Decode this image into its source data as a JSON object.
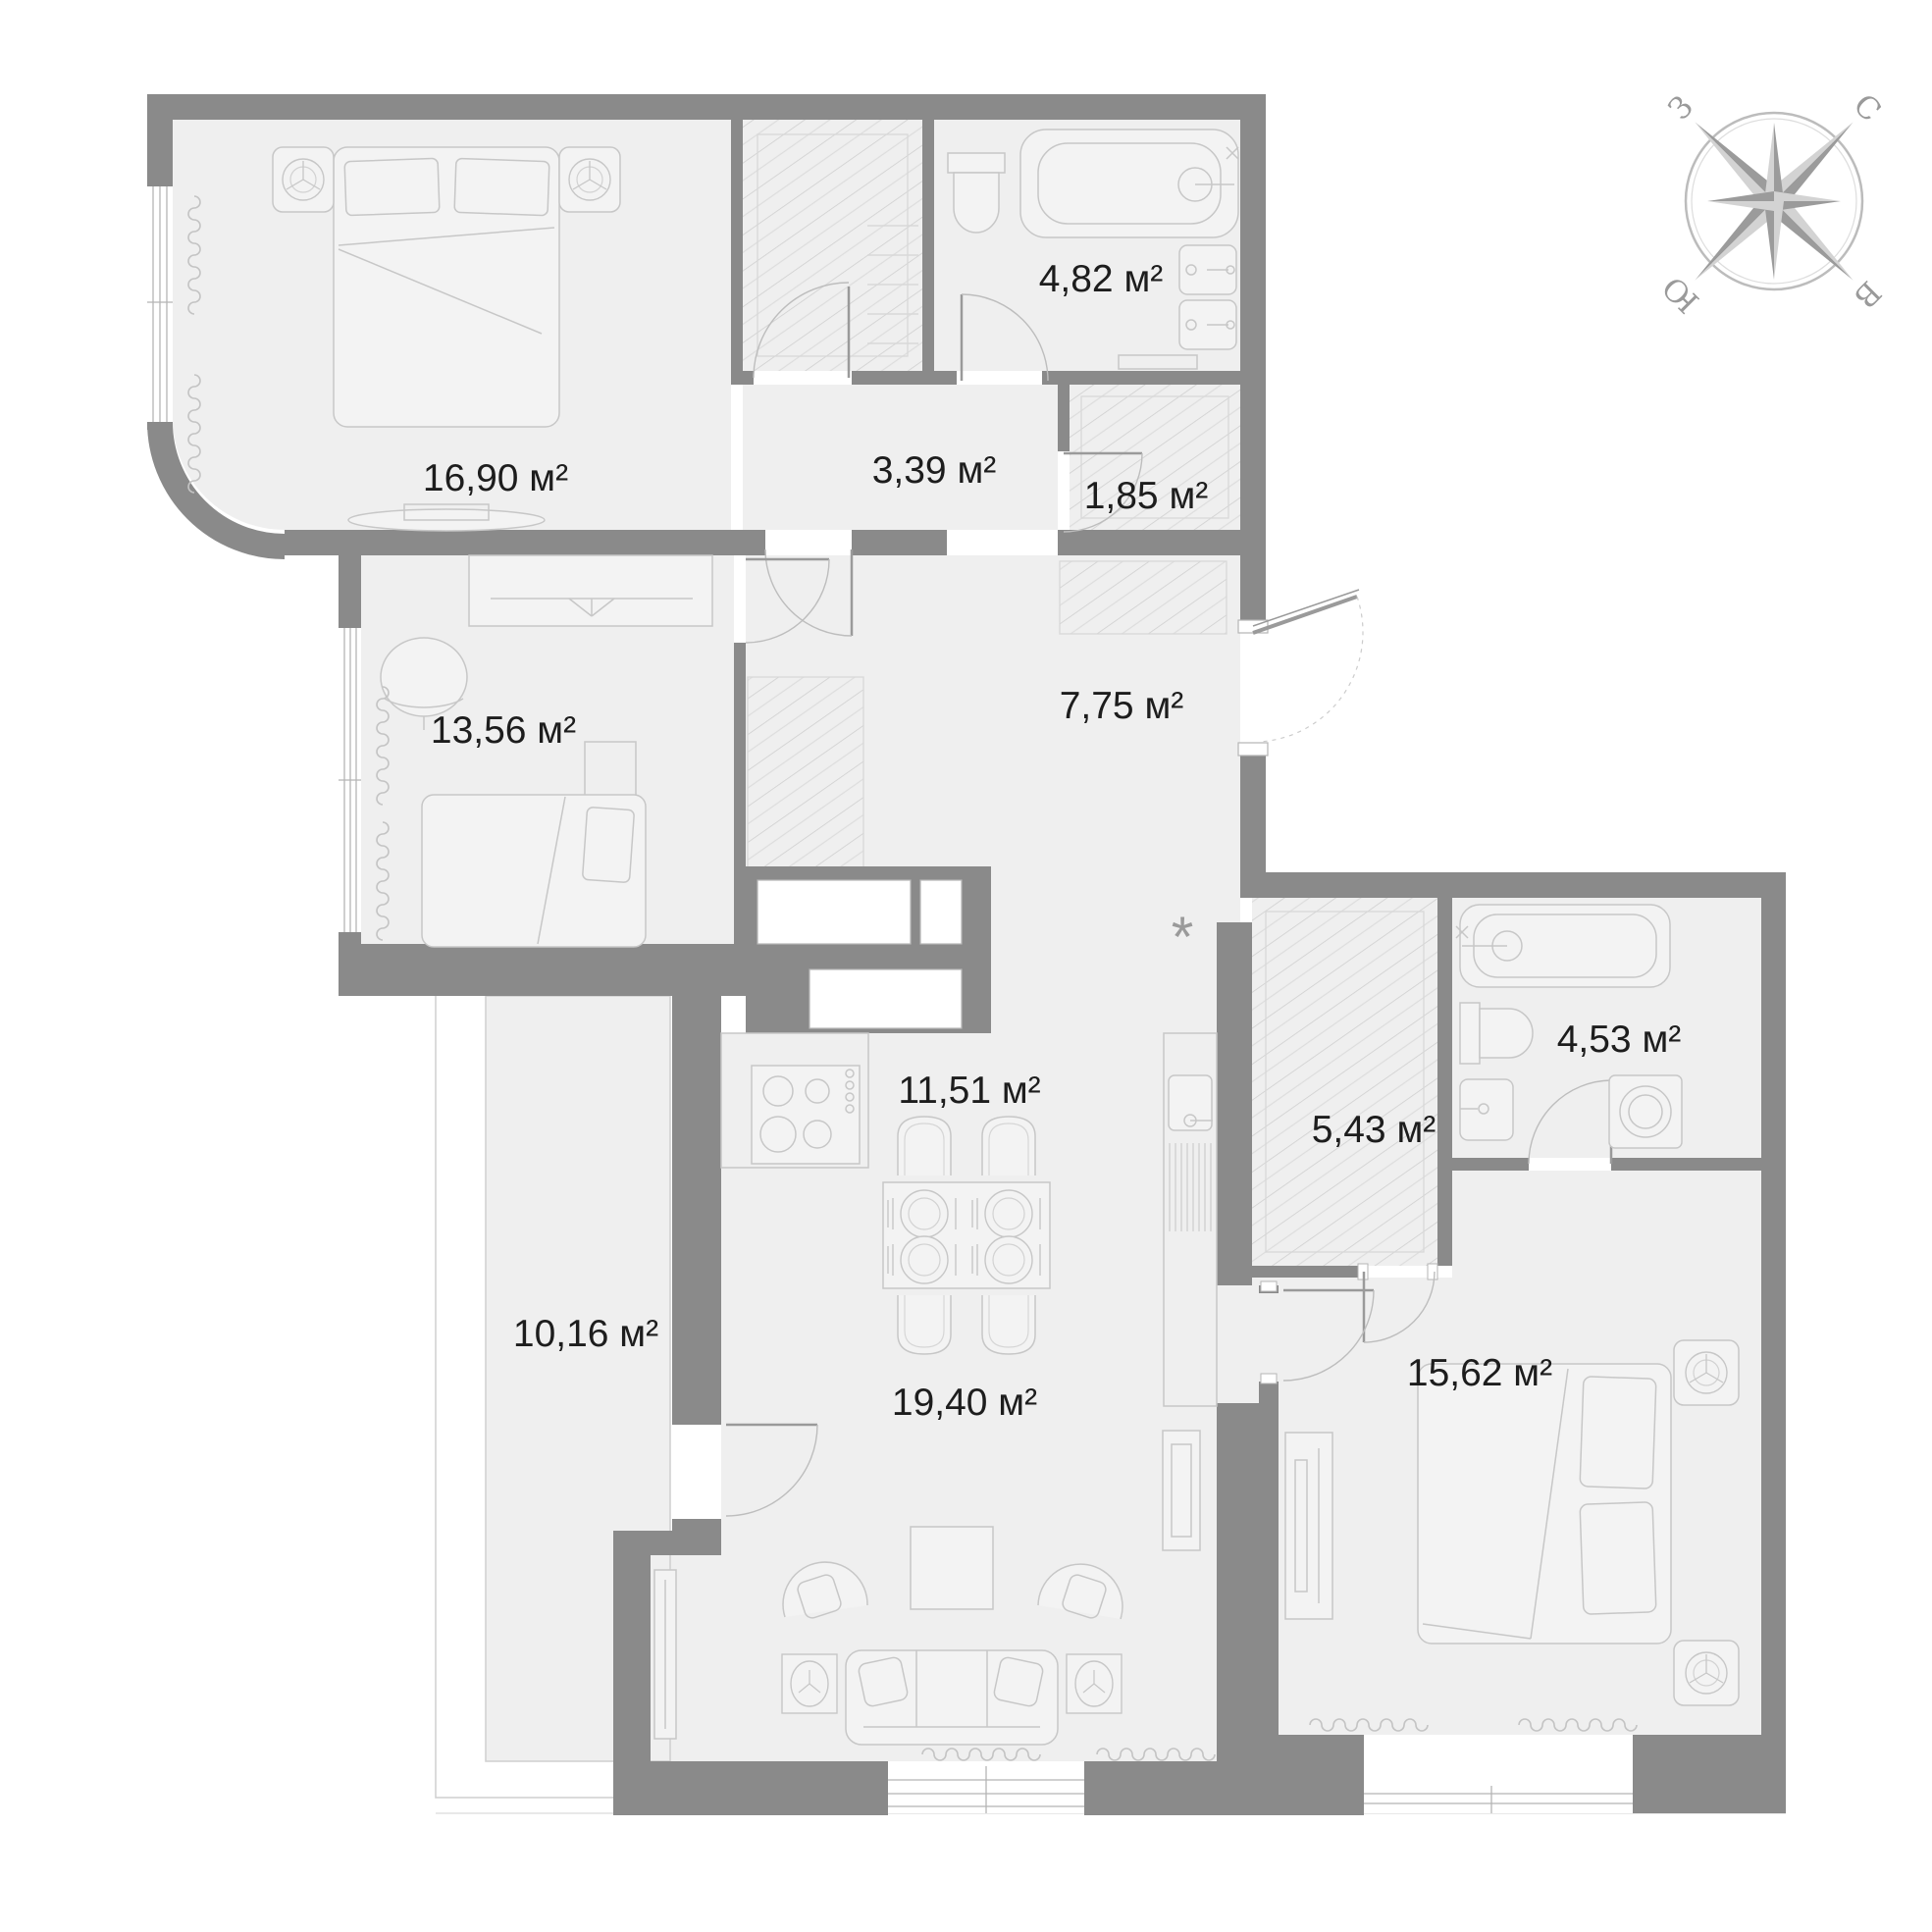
{
  "plan": {
    "title": "apartment-floor-plan",
    "rooms": [
      {
        "name": "bedroom-1",
        "area": "16,90 м²"
      },
      {
        "name": "bathroom-1",
        "area": "4,82 м²"
      },
      {
        "name": "hallway",
        "area": "3,39 м²"
      },
      {
        "name": "storage",
        "area": "1,85 м²"
      },
      {
        "name": "bedroom-2",
        "area": "13,56 м²"
      },
      {
        "name": "corridor",
        "area": "7,75 м²"
      },
      {
        "name": "kitchen-dining",
        "area": "11,51 м²"
      },
      {
        "name": "wardrobe",
        "area": "5,43 м²"
      },
      {
        "name": "bathroom-2",
        "area": "4,53 м²"
      },
      {
        "name": "balcony",
        "area": "10,16 м²"
      },
      {
        "name": "living-room",
        "area": "19,40 м²"
      },
      {
        "name": "bedroom-3",
        "area": "15,62 м²"
      }
    ],
    "kitchen_note": "*",
    "compass": {
      "north": "С",
      "east": "В",
      "south": "Ю",
      "west": "З"
    },
    "colors": {
      "wall": "#8a8a8a",
      "floor": "#efefef",
      "furniture_line": "#c7c7c7",
      "door_arc": "#bdbdbd",
      "text": "#1d1d1d",
      "compass_dark": "#9b9b9b",
      "compass_light": "#d3d3d3"
    }
  }
}
